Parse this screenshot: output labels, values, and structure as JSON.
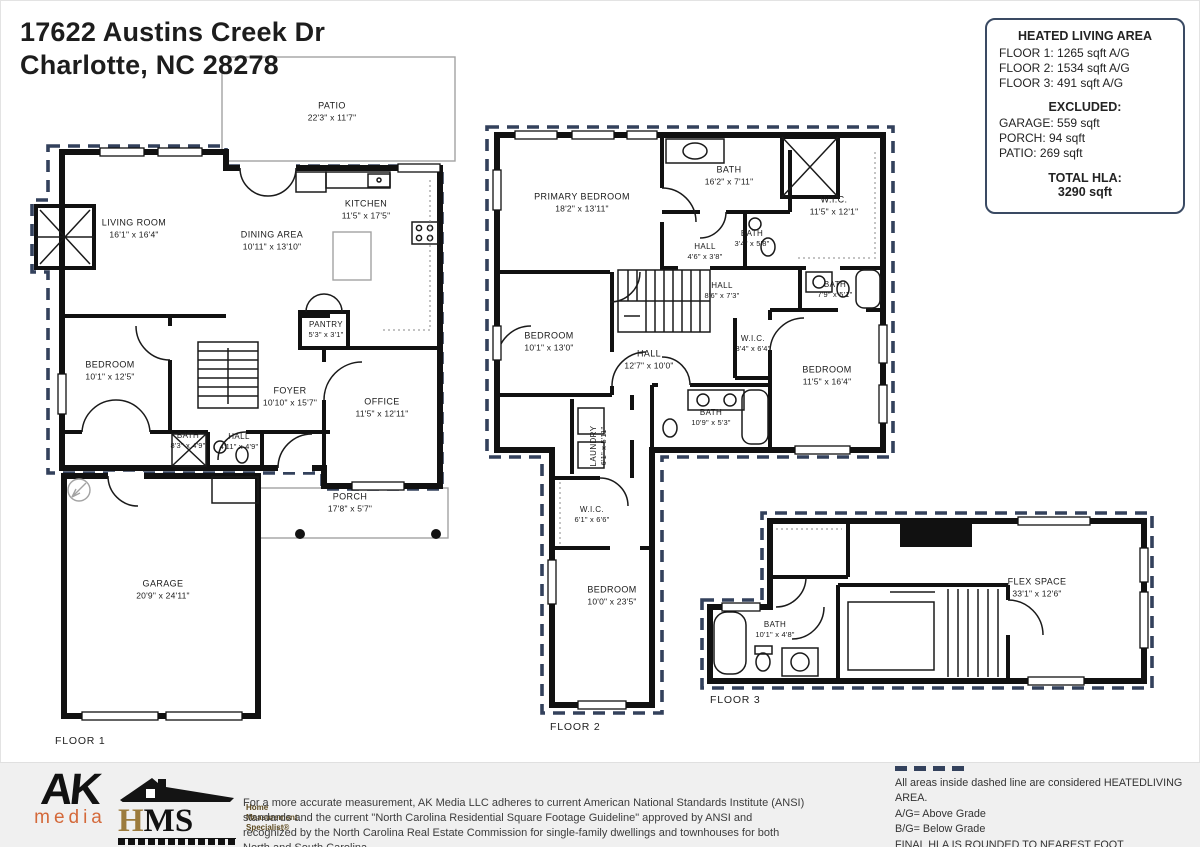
{
  "address": {
    "line1": "17622 Austins Creek Dr",
    "line2": "Charlotte, NC  28278"
  },
  "hla": {
    "title": "HEATED LIVING AREA",
    "floor_lines": [
      "FLOOR 1: 1265 sqft A/G",
      "FLOOR 2: 1534 sqft  A/G",
      "FLOOR 3: 491 sqft  A/G"
    ],
    "excluded_title": "EXCLUDED:",
    "excluded_lines": [
      "GARAGE: 559 sqft",
      "PORCH: 94 sqft",
      "PATIO: 269 sqft"
    ],
    "total_title": "TOTAL HLA:",
    "total_value": "3290 sqft"
  },
  "floors": [
    {
      "label": "FLOOR 1",
      "rooms": [
        {
          "name": "PATIO",
          "dims": "22'3\" x 11'7\""
        },
        {
          "name": "LIVING ROOM",
          "dims": "16'1\" x 16'4\""
        },
        {
          "name": "KITCHEN",
          "dims": "11'5\" x 17'5\""
        },
        {
          "name": "DINING AREA",
          "dims": "10'11\" x 13'10\""
        },
        {
          "name": "PANTRY",
          "dims": "5'3\" x 3'1\""
        },
        {
          "name": "BEDROOM",
          "dims": "10'1\" x 12'5\""
        },
        {
          "name": "FOYER",
          "dims": "10'10\" x 15'7\""
        },
        {
          "name": "OFFICE",
          "dims": "11'5\" x 12'11\""
        },
        {
          "name": "BATH",
          "dims": "8'3\" x 4'9\""
        },
        {
          "name": "HALL",
          "dims": "4'11\" x 4'9\""
        },
        {
          "name": "PORCH",
          "dims": "17'8\" x 5'7\""
        },
        {
          "name": "GARAGE",
          "dims": "20'9\" x 24'11\""
        }
      ]
    },
    {
      "label": "FLOOR 2",
      "rooms": [
        {
          "name": "PRIMARY BEDROOM",
          "dims": "18'2\" x 13'11\""
        },
        {
          "name": "BATH",
          "dims": "16'2\" x 7'11\""
        },
        {
          "name": "W.I.C.",
          "dims": "11'5\" x 12'1\""
        },
        {
          "name": "HALL",
          "dims": "4'6\" x 3'8\""
        },
        {
          "name": "BATH",
          "dims": "3'4\" x 5'8\""
        },
        {
          "name": "HALL",
          "dims": "8'6\" x 7'3\""
        },
        {
          "name": "BATH",
          "dims": "7'9\" x 5'1\""
        },
        {
          "name": "BEDROOM",
          "dims": "10'1\" x 13'0\""
        },
        {
          "name": "HALL",
          "dims": "12'7\" x 10'0\""
        },
        {
          "name": "W.I.C.",
          "dims": "3'4\" x 6'4\""
        },
        {
          "name": "BEDROOM",
          "dims": "11'5\" x 16'4\""
        },
        {
          "name": "BATH",
          "dims": "10'9\" x 5'3\""
        },
        {
          "name": "LAUNDRY",
          "dims": "6'1\" x 5'11\""
        },
        {
          "name": "W.I.C.",
          "dims": "6'1\" x 6'6\""
        },
        {
          "name": "BEDROOM",
          "dims": "10'0\" x 23'5\""
        }
      ]
    },
    {
      "label": "FLOOR 3",
      "rooms": [
        {
          "name": "FLEX SPACE",
          "dims": "33'1\" x 12'6\""
        },
        {
          "name": "BATH",
          "dims": "10'1\" x 4'8\""
        }
      ]
    }
  ],
  "footer": {
    "ak": {
      "line1": "AK",
      "line2": "media"
    },
    "hms": {
      "h": "H",
      "ms": "MS",
      "tagline1": "Home",
      "tagline2": "Measurement",
      "tagline3": "Specialist®"
    },
    "disclaimer": "For a more accurate measurement, AK Media LLC adheres to current American National Standards Institute (ANSI) standards and the current \"North Carolina Residential Square Footage Guideline\" approved by ANSI and recognized by the North Carolina Real Estate Commission for single-family dwellings and townhouses for both North and South Carolina.",
    "legend": {
      "line1": "All areas inside dashed line are considered HEATEDLIVING AREA.",
      "line2": "A/G= Above Grade",
      "line3": "B/G= Below Grade",
      "line4": "FINAL HLA IS ROUNDED TO NEAREST FOOT"
    }
  },
  "colors": {
    "wall": "#111111",
    "heated_boundary": "#33415c",
    "ak_orange": "#d4693a",
    "hms_gold": "#9c7b3c"
  }
}
